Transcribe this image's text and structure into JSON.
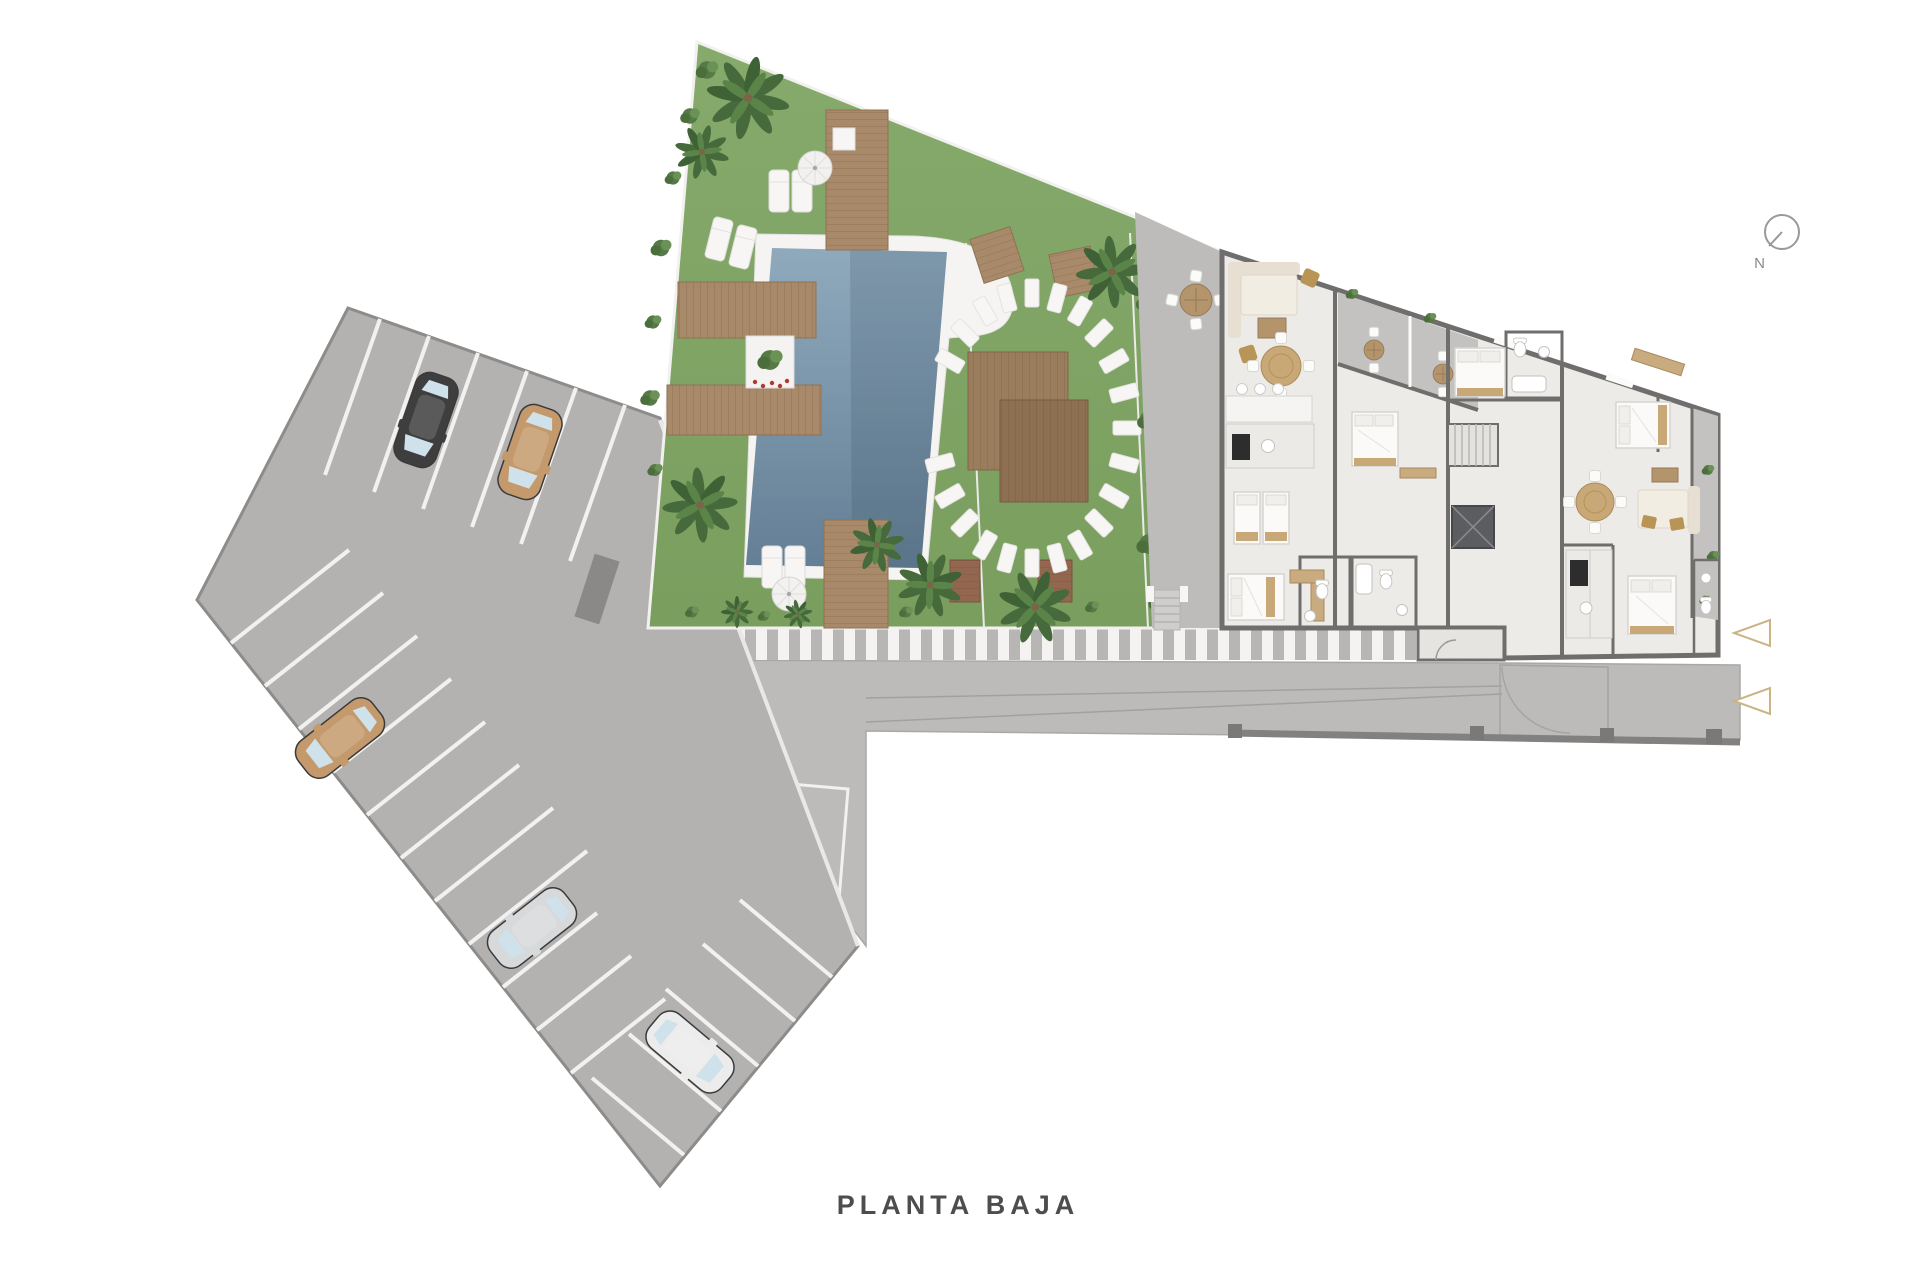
{
  "meta": {
    "type": "architectural-site-plan"
  },
  "labels": {
    "title": "PLANTA BAJA",
    "compass_north": "N"
  },
  "icons": {
    "compass": "compass-north-icon",
    "entrance_arrow": "triangle-left-arrow-icon",
    "entrance_arrow_count": 2
  },
  "palette": {
    "background": "#ffffff",
    "grass": "#80a463",
    "palm": "#466a3c",
    "pool_water_light": "#8fa9bd",
    "pool_water_dark": "#647f95",
    "wood_deck": "#a8896a",
    "pavement_parking": "#b3b2b1",
    "pavement_road": "#bcbbba",
    "crosswalk_stripe": "#f4f3f2",
    "building_floor": "#edebe8",
    "terrace_floor": "#c3c2c0",
    "wall": "#6f6e6d",
    "furniture_wood": "#c9ab80",
    "arrow_accent": "#c9b486",
    "text": "#4d4d4c"
  },
  "site": {
    "parking": {
      "stall_rows": 3,
      "cars": [
        {
          "color_name": "black",
          "hex": "#3f3e3e"
        },
        {
          "color_name": "tan",
          "hex": "#c49a6c"
        },
        {
          "color_name": "tan",
          "hex": "#c49a6c"
        },
        {
          "color_name": "silver",
          "hex": "#d8d9da"
        },
        {
          "color_name": "white",
          "hex": "#ececec"
        }
      ]
    },
    "garden": {
      "features": [
        "swimming-pool",
        "wood-decks",
        "sun-loungers",
        "parasols",
        "palm-trees",
        "stepping-stone-arc",
        "pergola-platforms",
        "planter",
        "hedge"
      ]
    },
    "building": {
      "rooms": [
        "living-rooms",
        "bedrooms",
        "bathrooms",
        "kitchens",
        "terraces",
        "stair-core",
        "elevator",
        "balcony"
      ]
    },
    "road": {
      "features": [
        "striped-walkway",
        "garage-ramp",
        "marked-bay"
      ]
    }
  }
}
